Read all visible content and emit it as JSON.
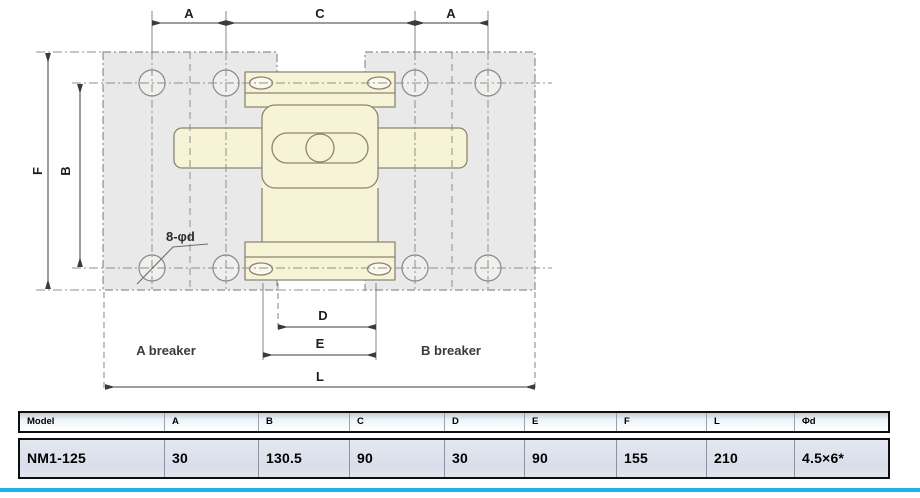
{
  "drawing": {
    "dim_a_left": "A",
    "dim_c": "C",
    "dim_a_right": "A",
    "dim_f": "F",
    "dim_b": "B",
    "dim_d": "D",
    "dim_e": "E",
    "dim_l": "L",
    "hole_callout": "8-φd",
    "label_a_breaker": "A breaker",
    "label_b_breaker": "B breaker"
  },
  "table": {
    "headers": [
      "Model",
      "A",
      "B",
      "C",
      "D",
      "E",
      "F",
      "L",
      "Φd"
    ],
    "rows": [
      [
        "NM1-125",
        "30",
        "130.5",
        "90",
        "30",
        "90",
        "155",
        "210",
        "4.5×6*"
      ]
    ]
  },
  "colors": {
    "accent_bar": "#1fb1ea",
    "breaker_fill": "#f7f3d6",
    "panel_fill": "#e8e9e8"
  }
}
